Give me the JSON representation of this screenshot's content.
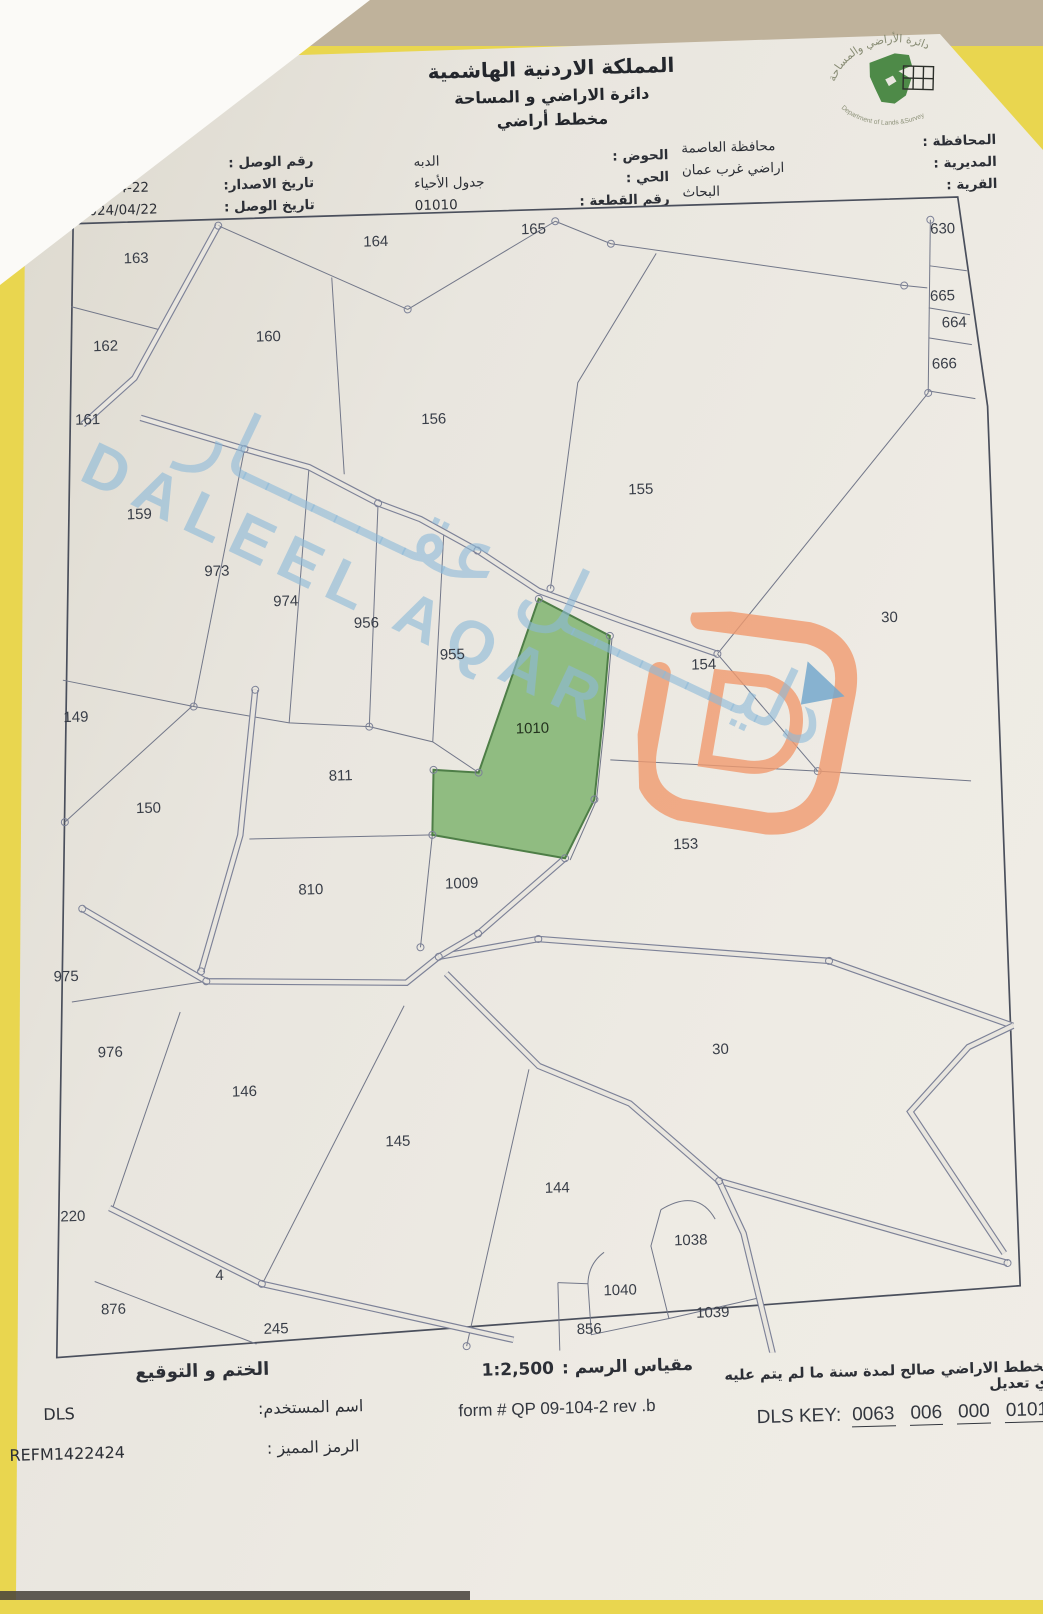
{
  "header": {
    "kingdom": "المملكة الاردنية الهاشمية",
    "department": "دائرة الاراضي و المساحة",
    "doc_type": "مخطط أراضي",
    "logo": {
      "top_text": "دائرة الأراضي والمساحة",
      "bottom_text": "Department of Lands &Survey"
    }
  },
  "fields": {
    "left": [
      {
        "label": "رقم الوصل :",
        "value": "51118"
      },
      {
        "label": "تاريخ الاصدار:",
        "value": "2024-4-22"
      },
      {
        "label": "تاريخ الوصل :",
        "value": "2024/04/22"
      }
    ],
    "center": [
      {
        "label": "الحوض :",
        "value": "الدبه"
      },
      {
        "label": "الحي :",
        "value": "جدول الأحياء"
      },
      {
        "label": "رقم القطعة :",
        "value": "01010"
      }
    ],
    "right": [
      {
        "label": "المحافظة :",
        "value": "محافظة العاصمة"
      },
      {
        "label": "المديرية :",
        "value": "اراضي غرب عمان"
      },
      {
        "label": "القرية :",
        "value": "البحاث"
      }
    ]
  },
  "map": {
    "highlighted_parcel": "1010",
    "highlight_color": "#8cba7c",
    "line_color": "#727789",
    "parcels": [
      {
        "id": "163",
        "x": 120,
        "y": 50
      },
      {
        "id": "164",
        "x": 360,
        "y": 40
      },
      {
        "id": "165",
        "x": 518,
        "y": 32
      },
      {
        "id": "630",
        "x": 927,
        "y": 43
      },
      {
        "id": "665",
        "x": 925,
        "y": 110
      },
      {
        "id": "664",
        "x": 936,
        "y": 137
      },
      {
        "id": "666",
        "x": 925,
        "y": 178
      },
      {
        "id": "162",
        "x": 87,
        "y": 137
      },
      {
        "id": "160",
        "x": 250,
        "y": 132
      },
      {
        "id": "161",
        "x": 67,
        "y": 210
      },
      {
        "id": "156",
        "x": 413,
        "y": 219
      },
      {
        "id": "155",
        "x": 618,
        "y": 295
      },
      {
        "id": "159",
        "x": 116,
        "y": 306
      },
      {
        "id": "973",
        "x": 192,
        "y": 365
      },
      {
        "id": "974",
        "x": 260,
        "y": 397
      },
      {
        "id": "956",
        "x": 340,
        "y": 421
      },
      {
        "id": "955",
        "x": 425,
        "y": 455
      },
      {
        "id": "30",
        "x": 863,
        "y": 430
      },
      {
        "id": "154",
        "x": 676,
        "y": 472
      },
      {
        "id": "149",
        "x": 47,
        "y": 507
      },
      {
        "id": "1010",
        "x": 503,
        "y": 531,
        "highlight": true
      },
      {
        "id": "811",
        "x": 310,
        "y": 573
      },
      {
        "id": "150",
        "x": 117,
        "y": 600
      },
      {
        "id": "153",
        "x": 653,
        "y": 651
      },
      {
        "id": "810",
        "x": 277,
        "y": 686
      },
      {
        "id": "1009",
        "x": 428,
        "y": 684
      },
      {
        "id": "975",
        "x": 30,
        "y": 766
      },
      {
        "id": "976",
        "x": 72,
        "y": 843
      },
      {
        "id": "146",
        "x": 205,
        "y": 886
      },
      {
        "id": "30",
        "x": 682,
        "y": 857
      },
      {
        "id": "145",
        "x": 357,
        "y": 940
      },
      {
        "id": "220",
        "x": 30,
        "y": 1006
      },
      {
        "id": "144",
        "x": 515,
        "y": 991
      },
      {
        "id": "4",
        "x": 175,
        "y": 1069
      },
      {
        "id": "1038",
        "x": 647,
        "y": 1047
      },
      {
        "id": "876",
        "x": 68,
        "y": 1100
      },
      {
        "id": "1040",
        "x": 575,
        "y": 1095
      },
      {
        "id": "245",
        "x": 230,
        "y": 1124
      },
      {
        "id": "1039",
        "x": 667,
        "y": 1120
      },
      {
        "id": "856",
        "x": 543,
        "y": 1133
      }
    ]
  },
  "watermark": {
    "arabic": "دليـــــــل عقـــــــار",
    "latin": "DALEEL AQAR",
    "color": "#8cb9d8",
    "logo_orange": "#f09a6e",
    "logo_flag_blue": "#74a8cc"
  },
  "footer": {
    "stamp_label": "الختم و التوقيع",
    "username_label": "اسم المستخدم:",
    "username": "DLS",
    "code_label": "الرمز المميز :",
    "code": "REFM1422424",
    "scale_label": "مقياس الرسم :",
    "scale_value": "1:2,500",
    "form_number": "form # QP 09-104-2 rev .b",
    "validity": "مخطط الاراضي صالح لمدة سنة ما لم يتم عليه أي تعديل",
    "dls_key_label": "DLS KEY:",
    "dls_key_groups": [
      "0063",
      "006",
      "000",
      "01010"
    ]
  }
}
